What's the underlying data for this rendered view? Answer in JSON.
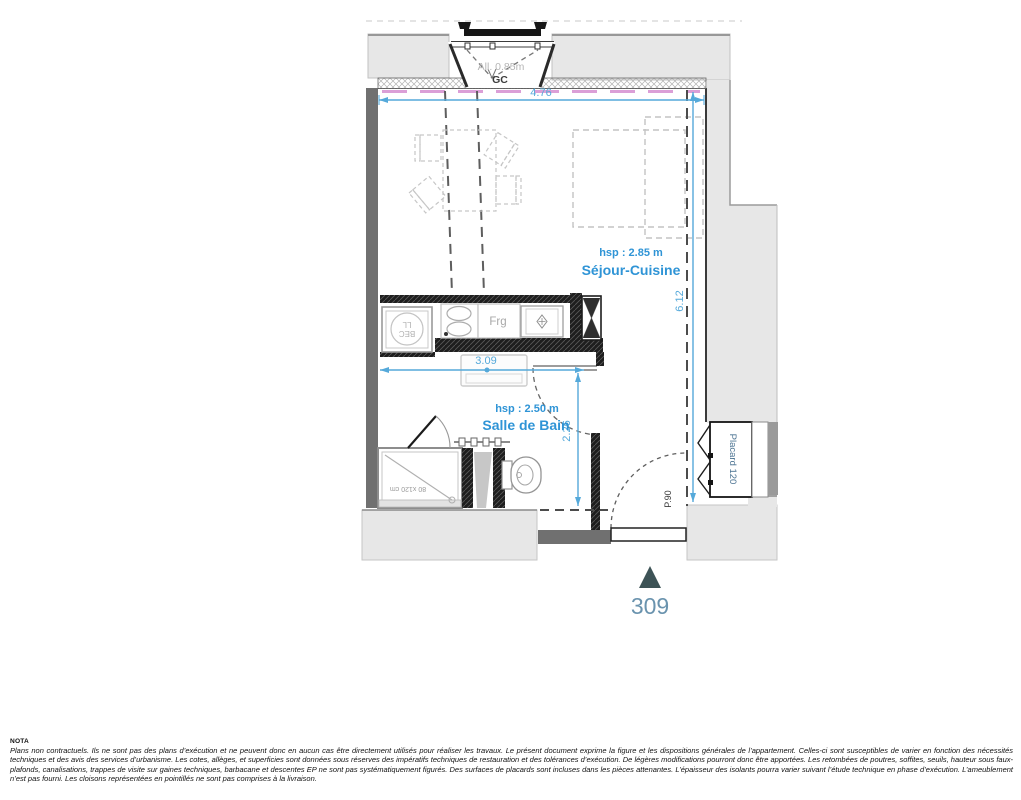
{
  "plan": {
    "unit": "309",
    "window": {
      "allege_label": "All. 0.85m",
      "gc_label": "GC"
    },
    "dims": {
      "width_top": "4.76",
      "height_right": "6.12",
      "width_kitchen": "3.09",
      "height_bath": "2.26"
    },
    "rooms": {
      "sejour_hsp": "hsp : 2.85 m",
      "sejour_name": "Séjour-Cuisine",
      "bath_hsp": "hsp : 2.50 m",
      "bath_name": "Salle de Bain"
    },
    "fixtures": {
      "fridge": "Frg",
      "washer_line1": "BEC",
      "washer_line2": "LL",
      "shower_size": "80 x120 cm",
      "placard": "Placard 120",
      "entry_door": "P.90"
    },
    "colors": {
      "dimension_blue": "#55a9da",
      "label_blue": "#2f94d6",
      "insulation_pink": "#db9fd7",
      "exterior_gray": "#e7e7e7",
      "wall_dark": "#707070",
      "wall_black": "#1e1e1e",
      "unit_blue": "#6a93ae",
      "marker_teal": "#3d5356"
    }
  },
  "nota": {
    "title": "NOTA",
    "body": "Plans non contractuels. Ils ne sont pas des plans d’exécution et ne peuvent donc en aucun cas être directement utilisés pour réaliser les travaux. Le présent document exprime la figure et les dispositions générales de l’appartement. Celles-ci sont susceptibles de varier en fonction des nécessités techniques et des avis des services d’urbanisme. Les cotes, allèges, et superficies sont données sous réserves des impératifs techniques de restauration et des tolérances d’exécution. De légères modifications pourront donc être apportées. Les retombées de poutres, soffites, seuils, hauteur sous faux-plafonds, canalisations, trappes de visite sur gaines techniques, barbacane et descentes EP ne sont pas systématiquement figurés. Des surfaces de placards sont incluses dans les pièces attenantes. L’épaisseur des isolants pourra varier suivant l’étude technique en phase d’exécution. L’ameublement n’est pas fourni. Les cloisons représentées en pointillés ne sont pas comprises à la livraison."
  }
}
